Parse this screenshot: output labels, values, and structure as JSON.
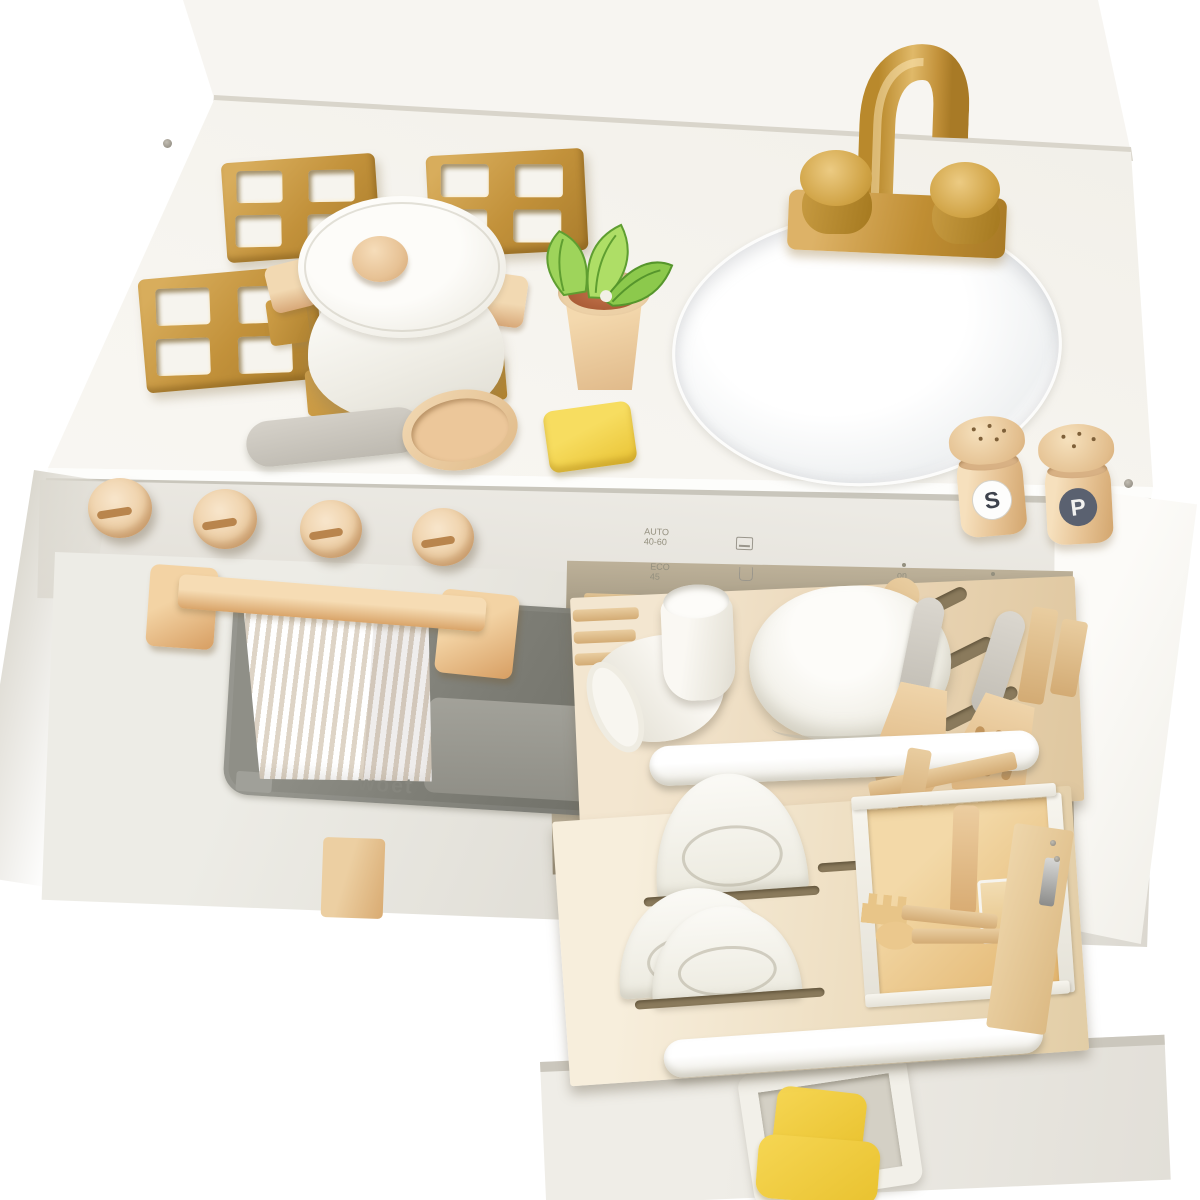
{
  "scene": {
    "title": "White wooden toy play kitchen with golden faucet and accessories",
    "brand": {
      "label": "woet"
    },
    "controls": {
      "oven_knobs": 4,
      "dishwasher": {
        "program_1": "AUTO 40-60",
        "program_2": "ECO 45",
        "program_icons": [
          "plate-icon",
          "glass-icon"
        ],
        "on_label": "on",
        "off_label": "off"
      }
    },
    "shakers": {
      "salt_letter": "S",
      "pepper_letter": "P"
    },
    "counter_items": [
      "burner-grate",
      "burner-grate",
      "burner-grate",
      "pot-with-lid",
      "wooden-spoon",
      "sponge",
      "potted-plant",
      "sink-basin",
      "gold-faucet",
      "salt-shaker",
      "pepper-shaker"
    ],
    "rack_items": {
      "upper_rack": [
        "tipped-cup",
        "cup",
        "large-pot",
        "wooden-spatula",
        "slotted-spatula",
        "wood-rail"
      ],
      "lower_rack": [
        "standing-plates",
        "saucers",
        "cutlery-caddy",
        "wooden-cutlery"
      ]
    },
    "bottom_drawer_items": [
      "toy-toast"
    ],
    "colors": {
      "background": "#ffffff",
      "cabinet_front": "#e9e7e0",
      "countertop": "#f7f5f0",
      "gold": "#c9993e",
      "wood_light": "#eccfa4",
      "wood_mid": "#d9a978",
      "oven_window": "#7d7d75",
      "towel_stripe": "#ded4c6",
      "sponge_yellow": "#f2d34d",
      "toast_yellow": "#f2cd3f",
      "leaf_green": "#9ed45b",
      "terracotta": "#b5643c",
      "handle_gray": "#c5c1ba",
      "salt_letter_color": "#3e434d",
      "pepper_label_bg": "#5a6170"
    }
  }
}
